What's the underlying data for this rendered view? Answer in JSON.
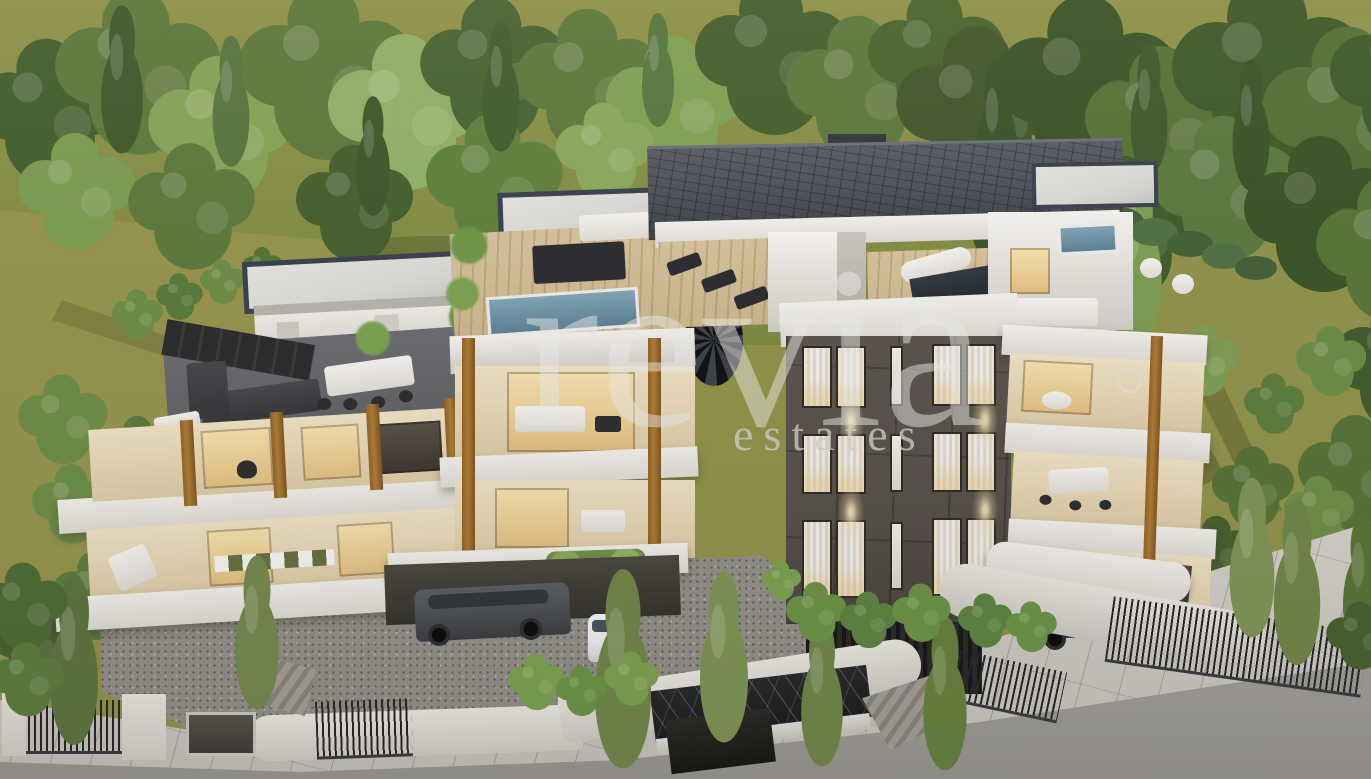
{
  "watermark": {
    "brand": "revia",
    "suffix": "estates"
  },
  "palette": {
    "forest-dark": "#425c31",
    "forest-mid": "#5d783d",
    "forest-light": "#84a257",
    "grass-olive": "#8f9149",
    "grass-shadow": "#6d7338",
    "roof-slate": "#4c5058",
    "roof-trim": "#3a4250",
    "roof-flat": "#d8d7d3",
    "wall-white": "#f1efea",
    "wall-shadow": "#cfccc5",
    "wall-cream": "#ecdfc2",
    "facade-dark": "#56504a",
    "wood": "#ad7b36",
    "deck-dark": "#5e6064",
    "deck-wood": "#c8b48c",
    "window-warm": "#f3dfae",
    "pool-blue": "#5c8193",
    "gravel": "#908d86",
    "concrete": "#dbd8d2",
    "sidewalk": "#cac7c0",
    "road": "#a4a29d",
    "plant-green": "#6e8c48",
    "marble-dark": "#1b1d1f",
    "car-gray": "#4b4e52",
    "car-white": "#e9eaea"
  }
}
